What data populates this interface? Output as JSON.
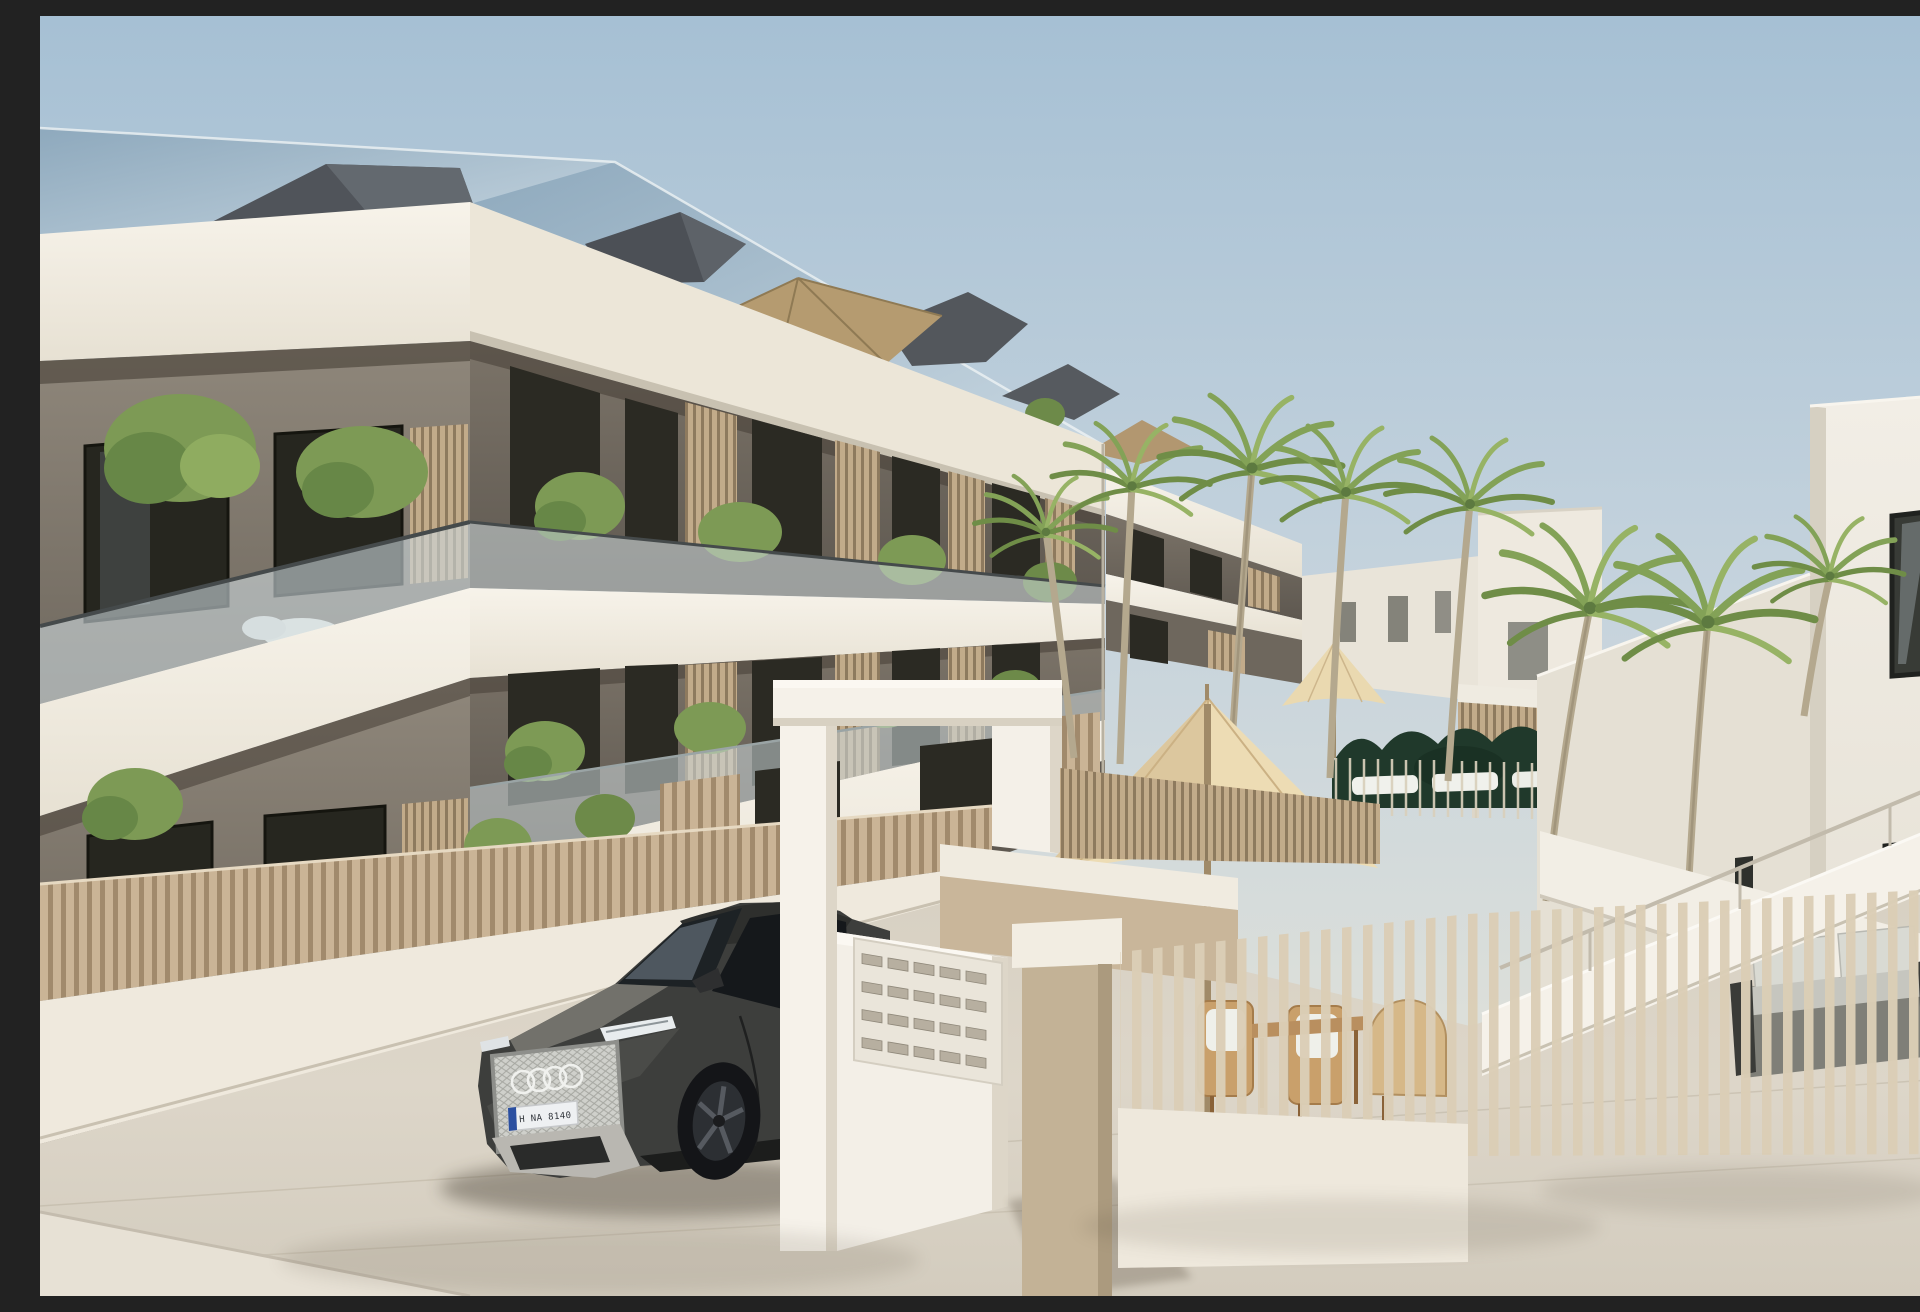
{
  "meta": {
    "title": "New-build apartment complex exterior render",
    "image_type": "architectural-render",
    "time_of_day": "day",
    "sky": "clear light blue"
  },
  "scene": {
    "description": "Modern three-storey apartment block with white slab balconies, taupe walls, glass balustrades and vertical wood-slat privacy screens under a glazed sloping roof with grey dormer volumes. A dark grey SUV is parked at the white entrance gate with a letterbox wall. To the right, a palm-filled pool courtyard with cream parasols, white sun loungers, a dark green hedge, a wooden outdoor dining set and a grey garden sofa; a white staircase leads to a second white building. Light stone paving in the foreground."
  },
  "building": {
    "floors": 3,
    "balustrade": "frameless glass",
    "balcony_screens": "vertical wood slats",
    "roof": "glazed slope with grey dormer volumes and tan rooftop parasol"
  },
  "entrance": {
    "structure": "white gate lintel with pillars and letterbox wall",
    "letterbox_rows": 4,
    "letterbox_cols": 5
  },
  "car": {
    "label": "dark grey SUV",
    "badge": "four overlapping rings",
    "license_plate": "H NA 8140",
    "plate_band_color": "#2b4fa0"
  },
  "pool_area": {
    "palm_count": 8,
    "lounger_count": 3,
    "parasols": [
      "tan rooftop parasol",
      "cream pool parasol",
      "large cream patio parasol"
    ],
    "dining": "wooden chairs with woven seats around a table",
    "sofa": "grey outdoor sofa with light cushions",
    "hedge": "dark green"
  },
  "palette": {
    "sky_top": "#a6c0d4",
    "sky_low": "#e2e2da",
    "slab_white": "#f4efe6",
    "wall_taupe": "#8e8679",
    "wall_dark": "#5e5850",
    "wood_slat": "#c9b394",
    "fence_gap": "#a18a6c",
    "pavement": "#dcd5c8",
    "hedge_green": "#20392b",
    "palm_green": "#83a257",
    "umbrella_cream": "#ead9b0",
    "car_grey": "#3d3e3c",
    "glass_roof": "#9db4c6"
  }
}
